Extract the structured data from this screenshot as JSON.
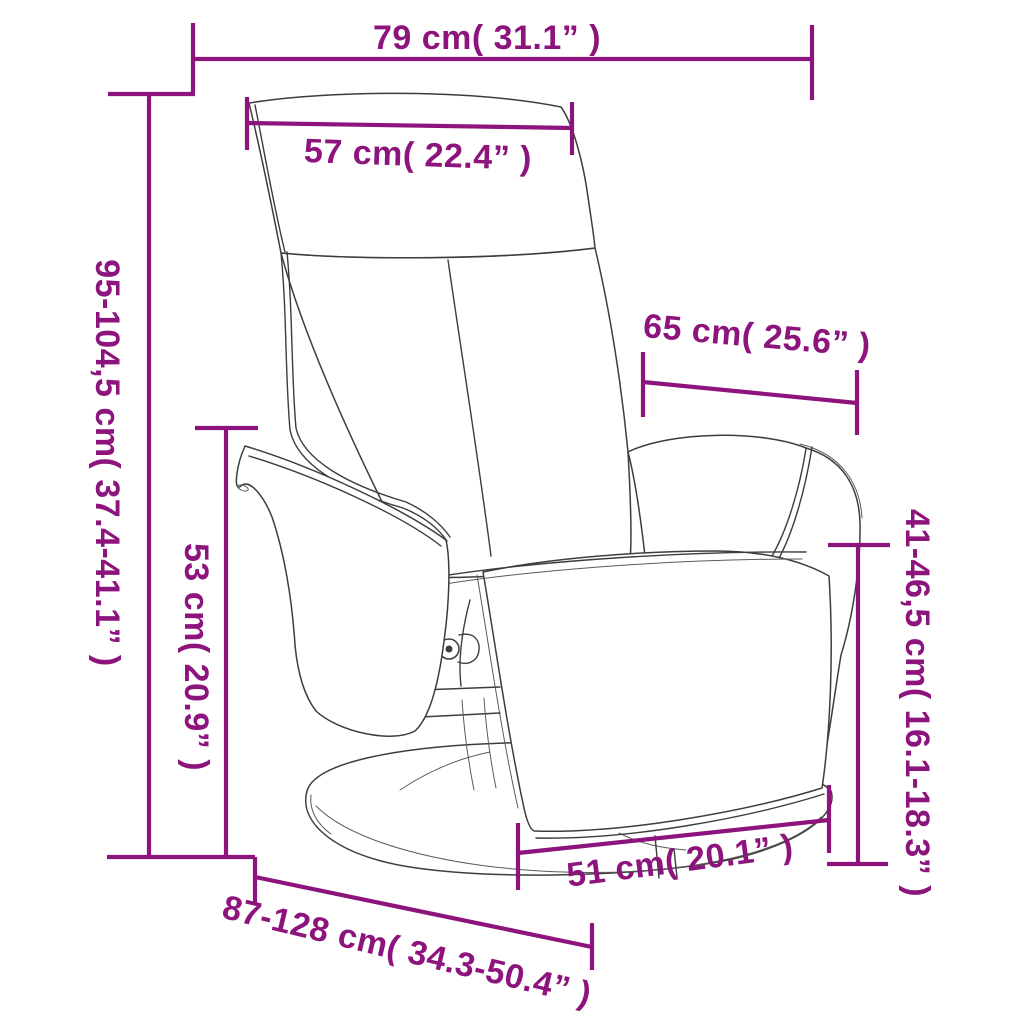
{
  "diagram": {
    "type": "product-dimension-diagram",
    "product": "recliner-chair-with-footrest",
    "accent_color": "#8E147D",
    "line_art_color": "#3D3D3D",
    "background_color": "#FFFFFF"
  },
  "dimensions": {
    "overall_width": {
      "label": "79 cm( 31.1” )",
      "cm": "79",
      "inches": "31.1"
    },
    "headrest_width": {
      "label": "57 cm( 22.4” )",
      "cm": "57",
      "inches": "22.4"
    },
    "overall_height": {
      "label": "95-104,5 cm( 37.4-41.1” )",
      "cm": "95-104,5",
      "inches": "37.4-41.1"
    },
    "seat_height": {
      "label": "53 cm( 20.9” )",
      "cm": "53",
      "inches": "20.9"
    },
    "backrest_width": {
      "label": "65 cm( 25.6” )",
      "cm": "65",
      "inches": "25.6"
    },
    "armrest_height": {
      "label": "41-46,5 cm( 16.1-18.3” )",
      "cm": "41-46,5",
      "inches": "16.1-18.3"
    },
    "seat_width": {
      "label": "51 cm( 20.1” )",
      "cm": "51",
      "inches": "20.1"
    },
    "depth_range": {
      "label": "87-128 cm( 34.3-50.4” )",
      "cm": "87-128",
      "inches": "34.3-50.4"
    }
  }
}
